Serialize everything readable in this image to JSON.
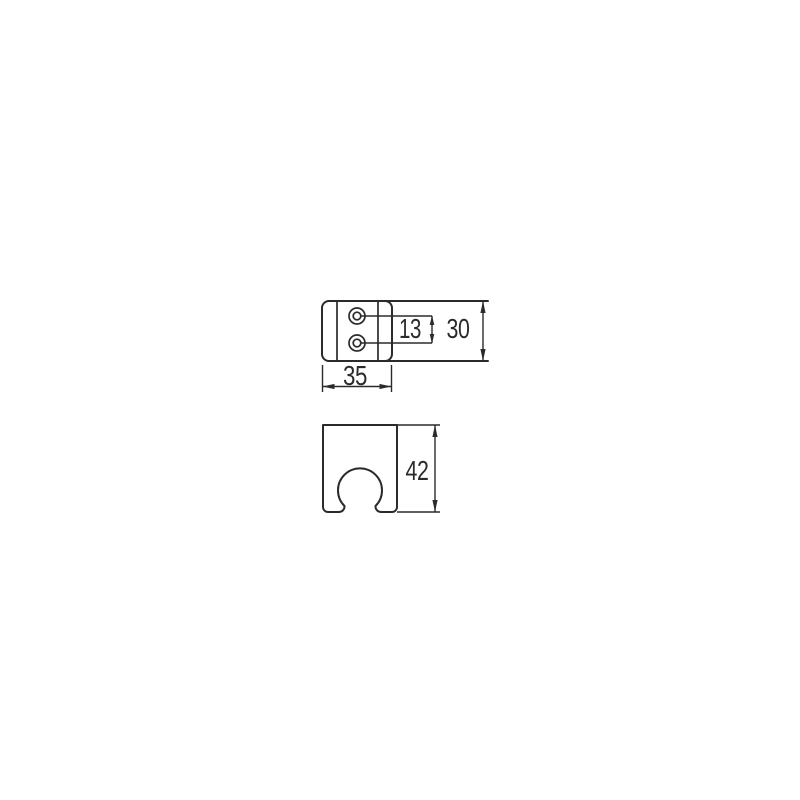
{
  "canvas": {
    "background": "#ffffff",
    "line_color": "#2b2b2b",
    "dimension_color": "#2b2b2b"
  },
  "views": {
    "side": {
      "hole_spacing": "13",
      "body_height": "30",
      "body_width": "35"
    },
    "front": {
      "body_height": "42"
    }
  }
}
